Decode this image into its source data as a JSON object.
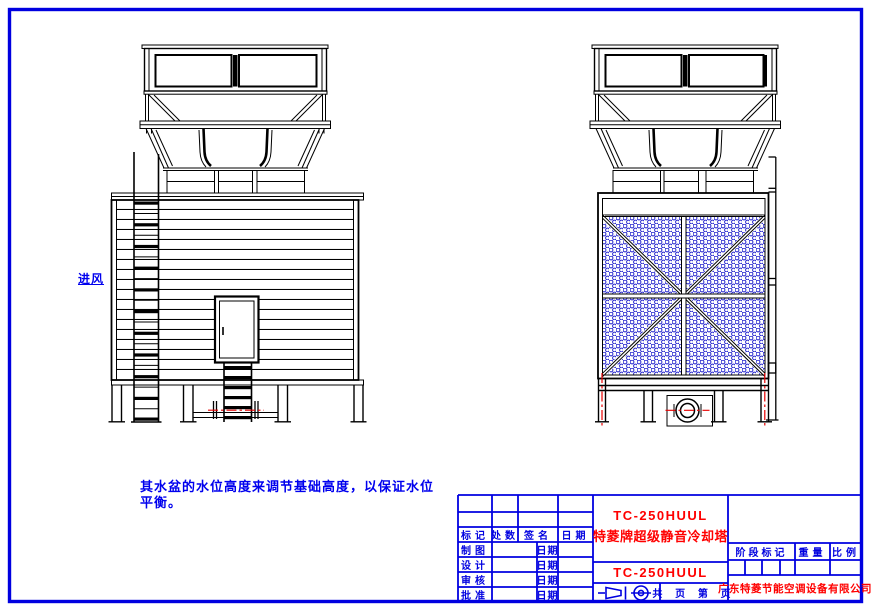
{
  "colors": {
    "frame_blue": "#0000e0",
    "line_black": "#000000",
    "accent_red": "#ff0000",
    "mesh_blue": "#2222cc",
    "note_blue": "#0000ee"
  },
  "annotations": {
    "air_inlet": "进风",
    "note_line1": "其水盆的水位高度来调节基础高度，以保证水位",
    "note_line2": "平衡。"
  },
  "title_block": {
    "model_number": "TC-250HUUL",
    "product_name": "特菱牌超级静音冷却塔",
    "drawing_number": "TC-250HUUL",
    "company": "广东特菱节能空调设备有限公司",
    "pages_label": "共 页 第 页",
    "revision_headers": [
      "标记",
      "处数",
      "签名",
      "日期"
    ],
    "rows": [
      {
        "label": "制图",
        "date": "日期"
      },
      {
        "label": "设计",
        "date": "日期"
      },
      {
        "label": "审核",
        "date": "日期"
      },
      {
        "label": "批准",
        "date": "日期"
      }
    ],
    "spec_headers": [
      "阶段标记",
      "重量",
      "比例"
    ]
  }
}
